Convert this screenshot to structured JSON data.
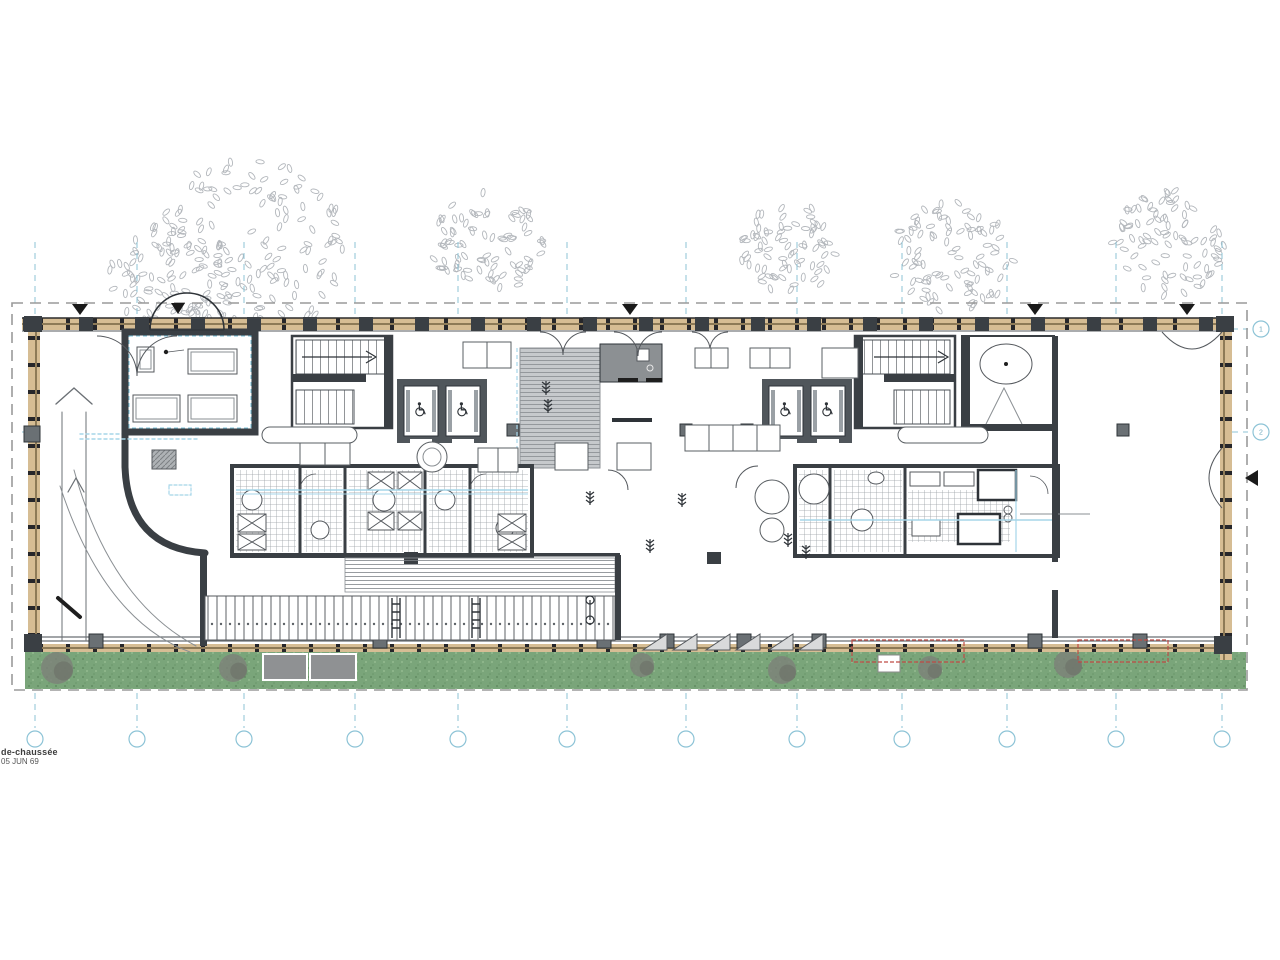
{
  "meta": {
    "caption_line1": "de-chaussée",
    "caption_line2": "05 JUN 69"
  },
  "colors": {
    "grid_blue": "#8cc3d6",
    "boundary_gray": "#9a9a9a",
    "wall_dark": "#3a3f44",
    "wall_gray": "#6a7074",
    "facade_tan": "#d6bd94",
    "grass_green": "#7aa57a",
    "red_dashed": "#bf4a44",
    "plumbing_blue": "#a5d5e8",
    "leaf_gray": "#b3b7bc"
  },
  "grid": {
    "vertical_x": [
      35,
      137,
      244,
      355,
      458,
      567,
      686,
      797,
      902,
      1007,
      1116,
      1222
    ],
    "bottom_labels": [
      "",
      "",
      "",
      "",
      "",
      "",
      "",
      "",
      "",
      "",
      "",
      ""
    ],
    "horizontal": [
      {
        "y": 329,
        "label": "1"
      },
      {
        "y": 432,
        "label": "2"
      }
    ],
    "bubble_y": 739,
    "bubble_x_right": 1261
  },
  "landscape": {
    "grass": {
      "x": 25,
      "y": 652,
      "w": 1221,
      "h": 37
    },
    "trees": [
      {
        "cx": 250,
        "cy": 252,
        "r": 100
      },
      {
        "cx": 172,
        "cy": 282,
        "r": 64
      },
      {
        "cx": 487,
        "cy": 243,
        "r": 56
      },
      {
        "cx": 789,
        "cy": 249,
        "r": 50
      },
      {
        "cx": 953,
        "cy": 258,
        "r": 62
      },
      {
        "cx": 1166,
        "cy": 243,
        "r": 58
      }
    ],
    "bushes": [
      {
        "cx": 57,
        "cy": 668,
        "r": 16
      },
      {
        "cx": 233,
        "cy": 668,
        "r": 14
      },
      {
        "cx": 642,
        "cy": 665,
        "r": 12
      },
      {
        "cx": 782,
        "cy": 670,
        "r": 14
      },
      {
        "cx": 930,
        "cy": 668,
        "r": 12
      },
      {
        "cx": 1068,
        "cy": 664,
        "r": 14
      }
    ]
  },
  "annotations": {
    "section_arrows_top_x": [
      80,
      630,
      1035,
      1187
    ],
    "section_arrow_top_y": 304,
    "canopy_arrow_x": 178,
    "right_arrow": {
      "x": 1258,
      "y": 478
    }
  }
}
